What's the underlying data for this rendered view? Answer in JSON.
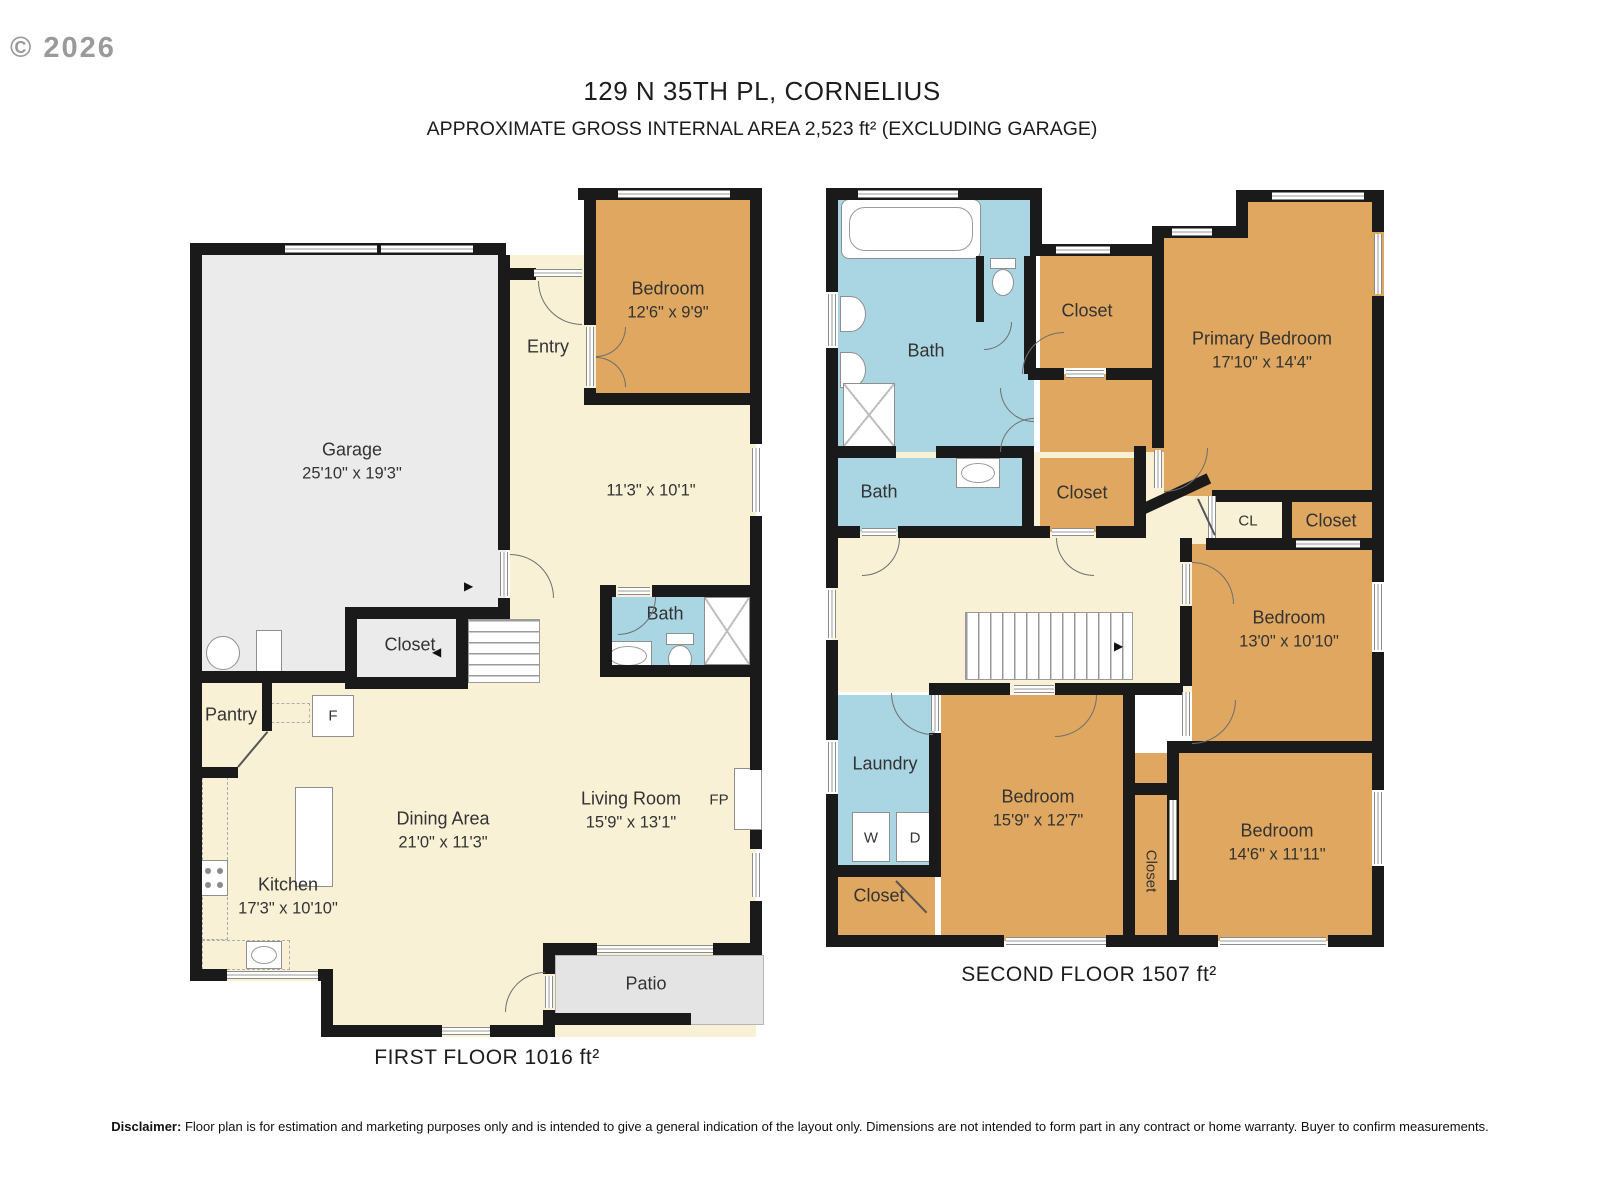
{
  "watermark": "© 2026",
  "header": {
    "title": "129 N 35TH PL, CORNELIUS",
    "subtitle": "APPROXIMATE GROSS INTERNAL AREA 2,523 ft² (EXCLUDING GARAGE)"
  },
  "colors": {
    "bedroom_tan": "#dfa75f",
    "floor_cream": "#f8f1d6",
    "bath_blue": "#aad5e2",
    "garage_gray": "#ebebeb",
    "patio_gray": "#e4e4e4",
    "wall_black": "#1a1a1a"
  },
  "icons": {
    "stair_arrow_right": "▶",
    "stair_arrow_left": "◀"
  },
  "f1": {
    "caption": "FIRST FLOOR 1016 ft²",
    "garage": {
      "name": "Garage",
      "dims": "25'10\" x 19'3\""
    },
    "entry": {
      "name": "Entry"
    },
    "bedroom": {
      "name": "Bedroom",
      "dims": "12'6\" x 9'9\""
    },
    "flex": {
      "dims": "11'3\" x 10'1\""
    },
    "closet": {
      "name": "Closet"
    },
    "bath": {
      "name": "Bath"
    },
    "pantry": {
      "name": "Pantry"
    },
    "fridge": "F",
    "kitchen": {
      "name": "Kitchen",
      "dims": "17'3\" x 10'10\""
    },
    "dining": {
      "name": "Dining Area",
      "dims": "21'0\" x 11'3\""
    },
    "living": {
      "name": "Living Room",
      "dims": "15'9\" x 13'1\""
    },
    "fireplace": "FP",
    "patio": {
      "name": "Patio"
    }
  },
  "f2": {
    "caption": "SECOND FLOOR 1507 ft²",
    "bath1": {
      "name": "Bath"
    },
    "closet_top": {
      "name": "Closet"
    },
    "primary": {
      "name": "Primary Bedroom",
      "dims": "17'10\" x 14'4\""
    },
    "bath2": {
      "name": "Bath"
    },
    "closet_mid": {
      "name": "Closet"
    },
    "cl": {
      "name": "CL"
    },
    "closet_right": {
      "name": "Closet"
    },
    "bedroom_right": {
      "name": "Bedroom",
      "dims": "13'0\" x 10'10\""
    },
    "laundry": {
      "name": "Laundry",
      "washer": "W",
      "dryer": "D"
    },
    "bedroom_center": {
      "name": "Bedroom",
      "dims": "15'9\" x 12'7\""
    },
    "closet_hall": {
      "name": "Closet"
    },
    "bedroom_bottom": {
      "name": "Bedroom",
      "dims": "14'6\" x 11'11\""
    },
    "closet_bl": {
      "name": "Closet"
    }
  },
  "disclaimer": {
    "label": "Disclaimer:",
    "text": " Floor plan is for estimation and marketing purposes only and is intended to give a general indication of the layout only. Dimensions are not intended to form part in any contract or home warranty. Buyer to confirm measurements."
  }
}
